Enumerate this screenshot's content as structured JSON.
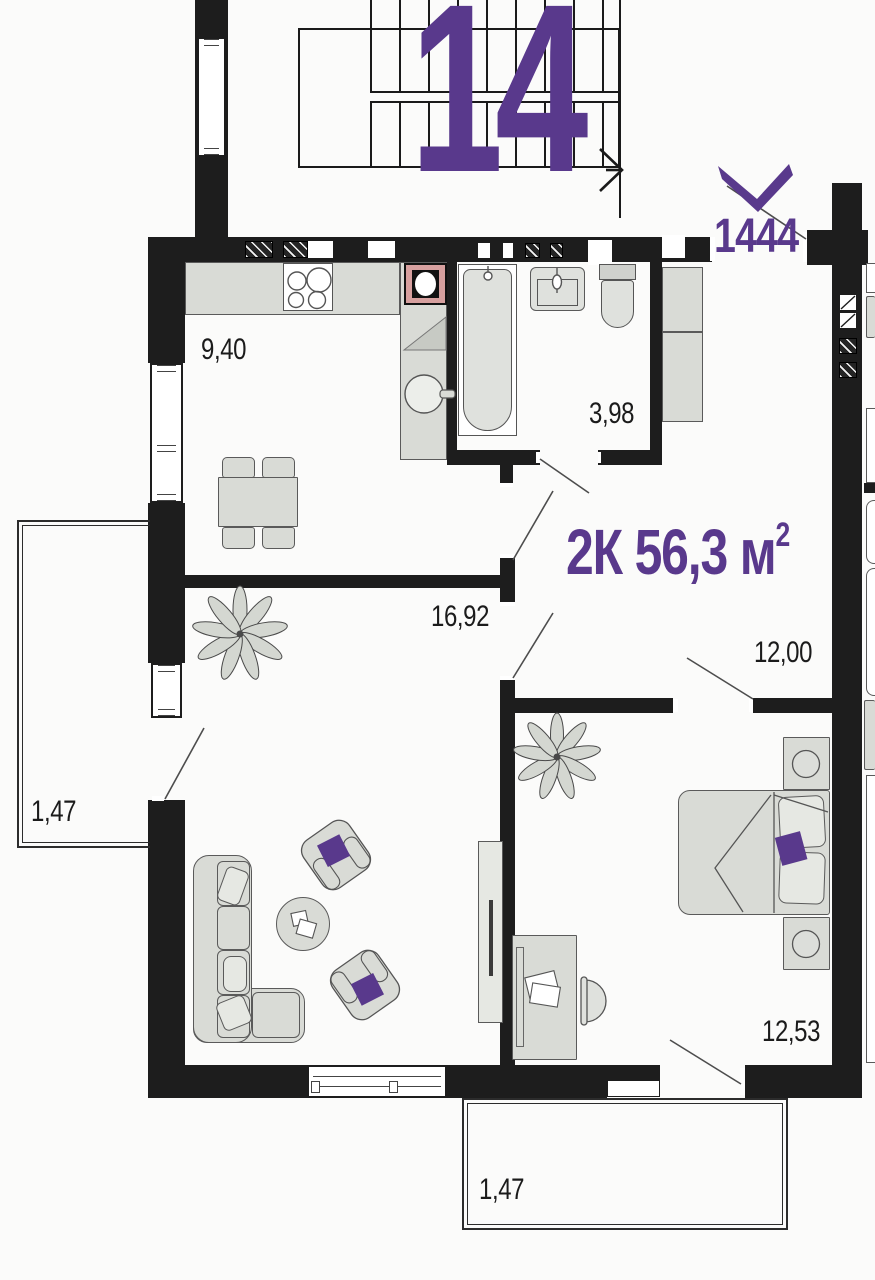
{
  "plan": {
    "big_number": "14",
    "unit_number": "1444",
    "total_area_main": "2К 56,3 м",
    "total_area_sup": "2",
    "rooms": {
      "kitchen": "9,40",
      "bathroom": "3,98",
      "living": "16,92",
      "hallway": "12,00",
      "bedroom": "12,53",
      "balcony_left": "1,47",
      "balcony_bottom": "1,47"
    },
    "colors": {
      "accent_purple": "#59398c",
      "wall_black": "#1d1d1d",
      "furniture_gray": "#d9dbd6",
      "washer_pink": "#d7a09f"
    }
  }
}
